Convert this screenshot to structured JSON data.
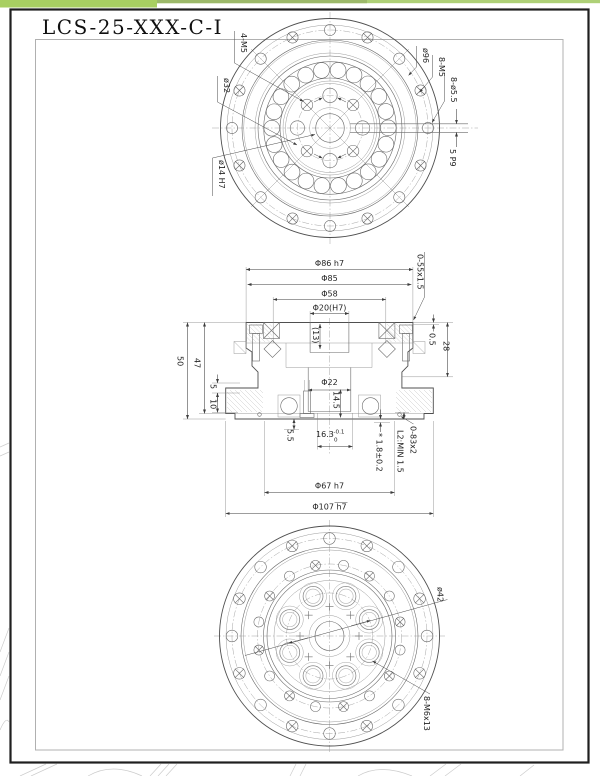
{
  "title": "LCS-25-XXX-C-I",
  "views": {
    "front": {
      "labels": {
        "bolt_4m5": "4-M5",
        "dia32": "ø32",
        "dia14": "ø14 H7",
        "dia96": "ø96",
        "bolt_8m5": "8-M5",
        "holes_8d55": "8-ø5.5",
        "keyway": "5 P9"
      }
    },
    "section": {
      "dims": {
        "d86": "Φ86 h7",
        "d85": "Φ85",
        "d58": "Φ58",
        "d20": "Φ20(H7)",
        "depth13": "(13)",
        "oring_top": "0-55x1.5",
        "gap05": "0.5",
        "h28": "28",
        "h50": "50",
        "h47": "47",
        "h5": "5",
        "h10": "10",
        "d22": "Φ22",
        "h145": "14.5",
        "h55": "5.5",
        "w163": "16.3",
        "w163_sup": "-0.1",
        "w163_sub": "0",
        "gap18": "* 1.8±0.2",
        "l2": "L2:MIN 1.5",
        "oring_bot": "0-83x2",
        "d67": "Φ67 h7",
        "d107": "Φ107 h7"
      }
    },
    "back": {
      "labels": {
        "dia42": "ø42",
        "bolt_8m6": "8-M6x13"
      }
    }
  },
  "colors": {
    "accent_green": "#a8cf62",
    "accent_green_light": "#aed077",
    "page_border": "#1f1f1f",
    "inner_frame": "#b0b0b0"
  }
}
